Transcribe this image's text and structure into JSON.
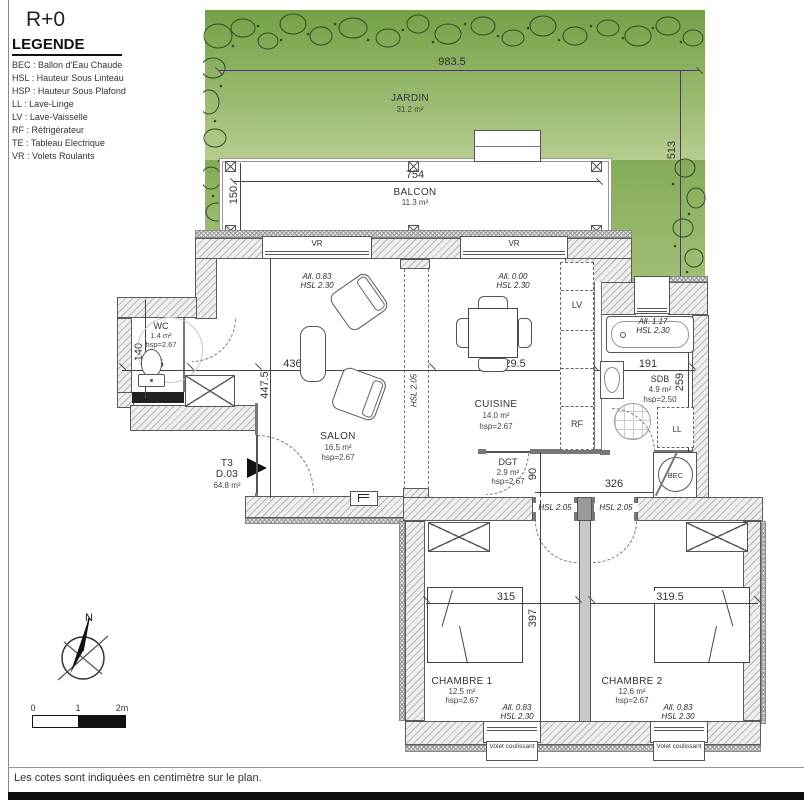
{
  "sheet": {
    "title": "R+0",
    "footer_note": "Les cotes sont indiquées en centimètre sur le plan."
  },
  "legend": {
    "heading": "LEGENDE",
    "items": [
      "BEC : Ballon d'Eau Chaude",
      "HSL : Hauteur Sous Linteau",
      "HSP : Hauteur Sous Plafond",
      "LL : Lave-Linge",
      "LV : Lave-Vaisselle",
      "RF : Réfrigérateur",
      "TE : Tableau Electrique",
      "VR : Volets Roulants"
    ]
  },
  "unit": {
    "type": "T3",
    "lot": "D.03",
    "area": "64.8 m²"
  },
  "garden": {
    "label": "JARDIN",
    "area": "31.2 m²"
  },
  "balcony": {
    "label": "BALCON",
    "area": "11.3 m²"
  },
  "rooms": {
    "wc": {
      "label": "WC",
      "area": "1.4 m²",
      "hsp": "hsp=2.67"
    },
    "salon": {
      "label": "SALON",
      "area": "16.5 m²",
      "hsp": "hsp=2.67"
    },
    "cuisine": {
      "label": "CUISINE",
      "area": "14.0 m²",
      "hsp": "hsp=2.67"
    },
    "sdb": {
      "label": "SDB",
      "area": "4.9 m²",
      "hsp": "hsp=2.50"
    },
    "dgt": {
      "label": "DGT",
      "area": "2.9 m²",
      "hsp": "hsp=2.67"
    },
    "chambre1": {
      "label": "CHAMBRE 1",
      "area": "12.5 m²",
      "hsp": "hsp=2.67"
    },
    "chambre2": {
      "label": "CHAMBRE 2",
      "area": "12.6 m²",
      "hsp": "hsp=2.67"
    }
  },
  "dimensions": {
    "garden_width": "983.5",
    "garden_depth": "513",
    "balcony_width": "754",
    "balcony_depth": "150",
    "wc_depth": "140",
    "wc_width": "99.5",
    "salon_width": "436.5",
    "salon_depth": "447.5",
    "cuisine_width": "329.5",
    "sdb_width": "191",
    "sdb_depth": "259",
    "dgt_depth": "90",
    "dgt_width": "326",
    "chambre1_width": "315",
    "chambre2_width": "319.5",
    "chambre_depth": "397"
  },
  "window_annotations": {
    "salon": [
      "All. 0.83",
      "HSL 2.30"
    ],
    "cuisine": [
      "All. 0.00",
      "HSL 2.30"
    ],
    "sdb": [
      "All. 1.17",
      "HSL 2.30"
    ],
    "chambre1": [
      "All. 0.83",
      "HSL 2.30"
    ],
    "chambre2": [
      "All. 0.83",
      "HSL 2.30"
    ]
  },
  "openings": {
    "vr1": "VR",
    "vr2": "VR",
    "hsl_salon_cuisine": "HSL 2.05",
    "hsl_chambre1": "HSL 2.05",
    "hsl_chambre2": "HSL 2.05",
    "volet1": "Volet coulissant",
    "volet2": "Volet coulissant"
  },
  "appliances": {
    "lv": "LV",
    "rf": "RF",
    "ll": "LL",
    "bec": "BEC"
  },
  "compass": {
    "north": "N"
  },
  "scale_bar": {
    "ticks": [
      "0",
      "1",
      "2m"
    ]
  },
  "colors": {
    "garden_top": "#74a049",
    "garden_bottom": "#b6cc8e",
    "wall_hatch_bg": "#efefef",
    "line": "#444444"
  }
}
